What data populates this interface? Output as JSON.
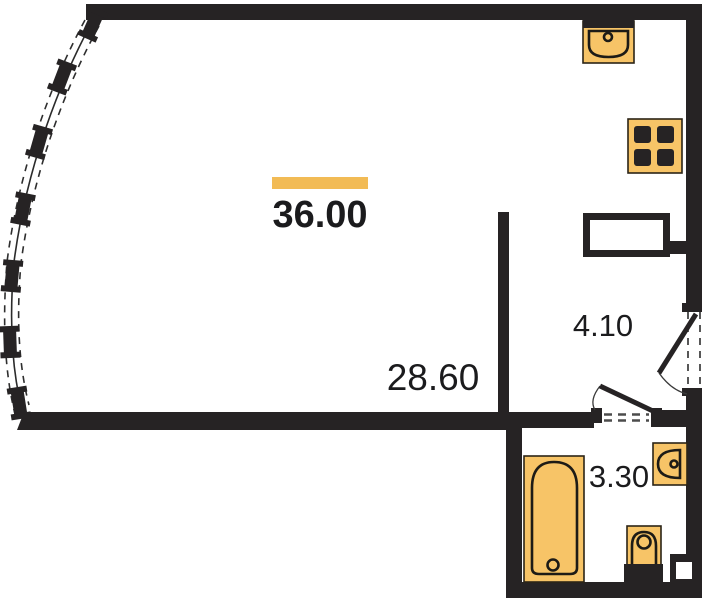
{
  "plan": {
    "type": "apartment-floor-plan",
    "total": {
      "area": "36.00"
    },
    "rooms": {
      "living": {
        "area": "28.60"
      },
      "hallway": {
        "area": "4.10"
      },
      "bathroom": {
        "area": "3.30"
      }
    },
    "icons": [
      "kitchen-sink-icon",
      "stove-icon",
      "bathtub-icon",
      "toilet-icon",
      "washbasin-icon",
      "window-mullion-icon",
      "door-swing-icon"
    ],
    "colors": {
      "wall": "#262324",
      "fixture_fill": "#F7C467",
      "accent": "#F2BB55",
      "text": "#1B1B1D",
      "background": "#FFFFFF"
    }
  }
}
